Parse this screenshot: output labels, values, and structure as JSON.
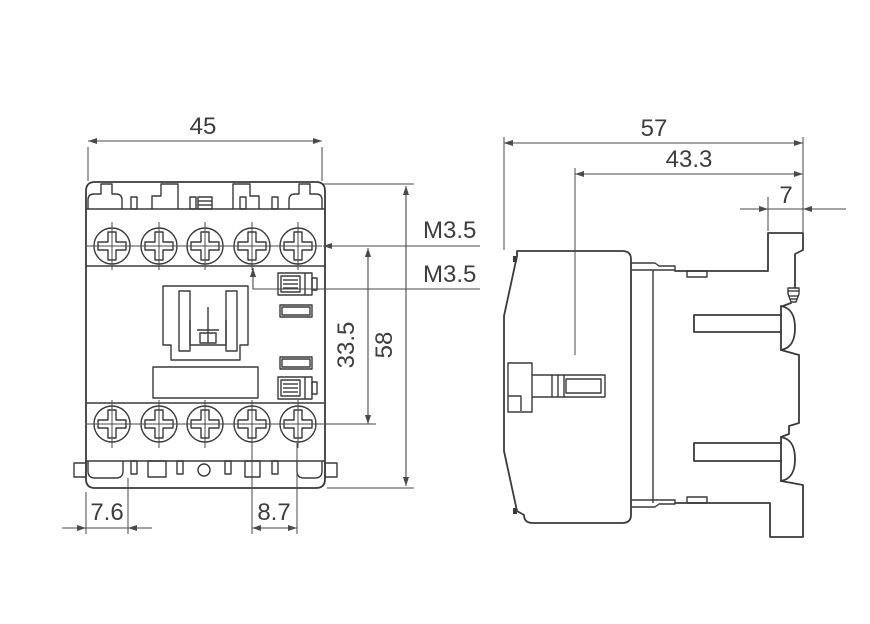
{
  "front_view": {
    "width": "45",
    "height": "58",
    "contact_row_span": "33.5",
    "main_terminal_thread": "M3.5",
    "aux_terminal_thread": "M3.5",
    "bottom_left_offset": "7.6",
    "terminal_pitch": "8.7"
  },
  "side_view": {
    "depth": "57",
    "body_depth": "43.3",
    "rail_step_width": "7"
  },
  "colors": {
    "line": "#3a3a3a",
    "text": "#3d3d3d",
    "background": "#ffffff"
  }
}
